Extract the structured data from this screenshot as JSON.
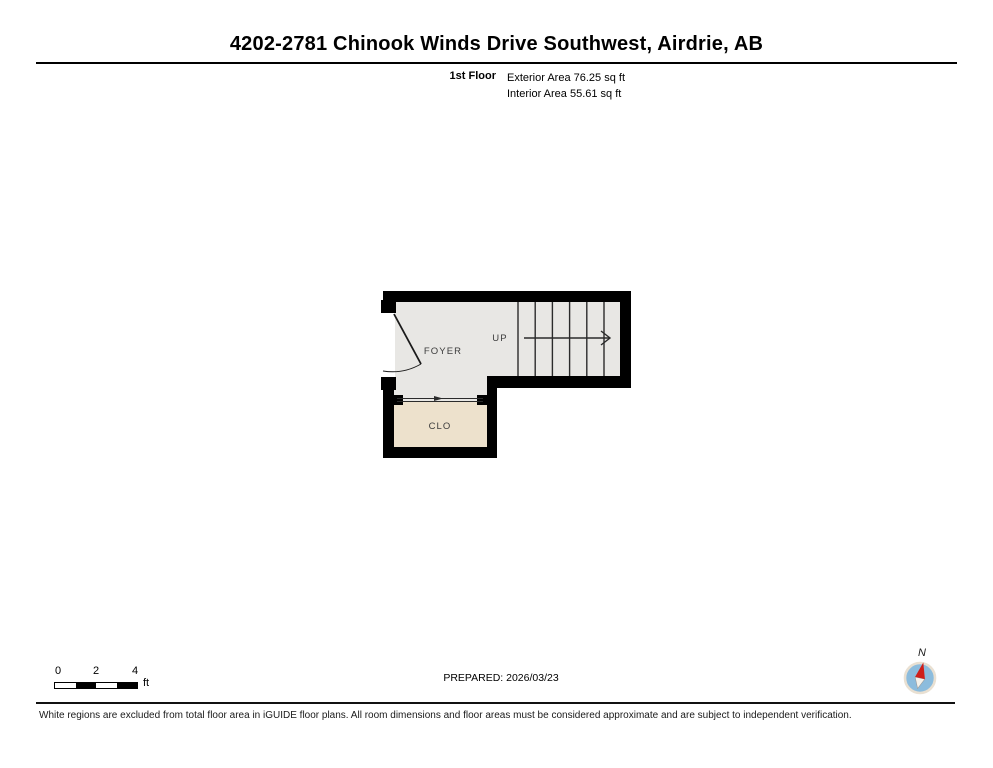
{
  "header": {
    "title": "4202-2781 Chinook Winds Drive Southwest, Airdrie, AB",
    "floor_label": "1st Floor",
    "exterior_area": "Exterior Area 76.25 sq ft",
    "interior_area": "Interior Area 55.61 sq ft"
  },
  "floor_plan": {
    "rooms": [
      {
        "label": "FOYER",
        "floor_color": "#e8e7e4"
      },
      {
        "label": "CLO",
        "floor_color": "#ede1cc"
      }
    ],
    "stairs": {
      "label": "UP",
      "tread_count": 7
    },
    "wall_color": "#000000"
  },
  "footer": {
    "scale_bar": {
      "ticks": [
        "0",
        "2",
        "4"
      ],
      "unit": "ft"
    },
    "prepared_label": "PREPARED: 2026/03/23",
    "compass": {
      "label": "N",
      "dial_color": "#8cbcdd",
      "needle_color": "#cf1f1a"
    },
    "disclaimer": "White regions are excluded from total floor area in iGUIDE floor plans. All room dimensions and floor areas must be considered approximate and are subject to independent verification."
  }
}
